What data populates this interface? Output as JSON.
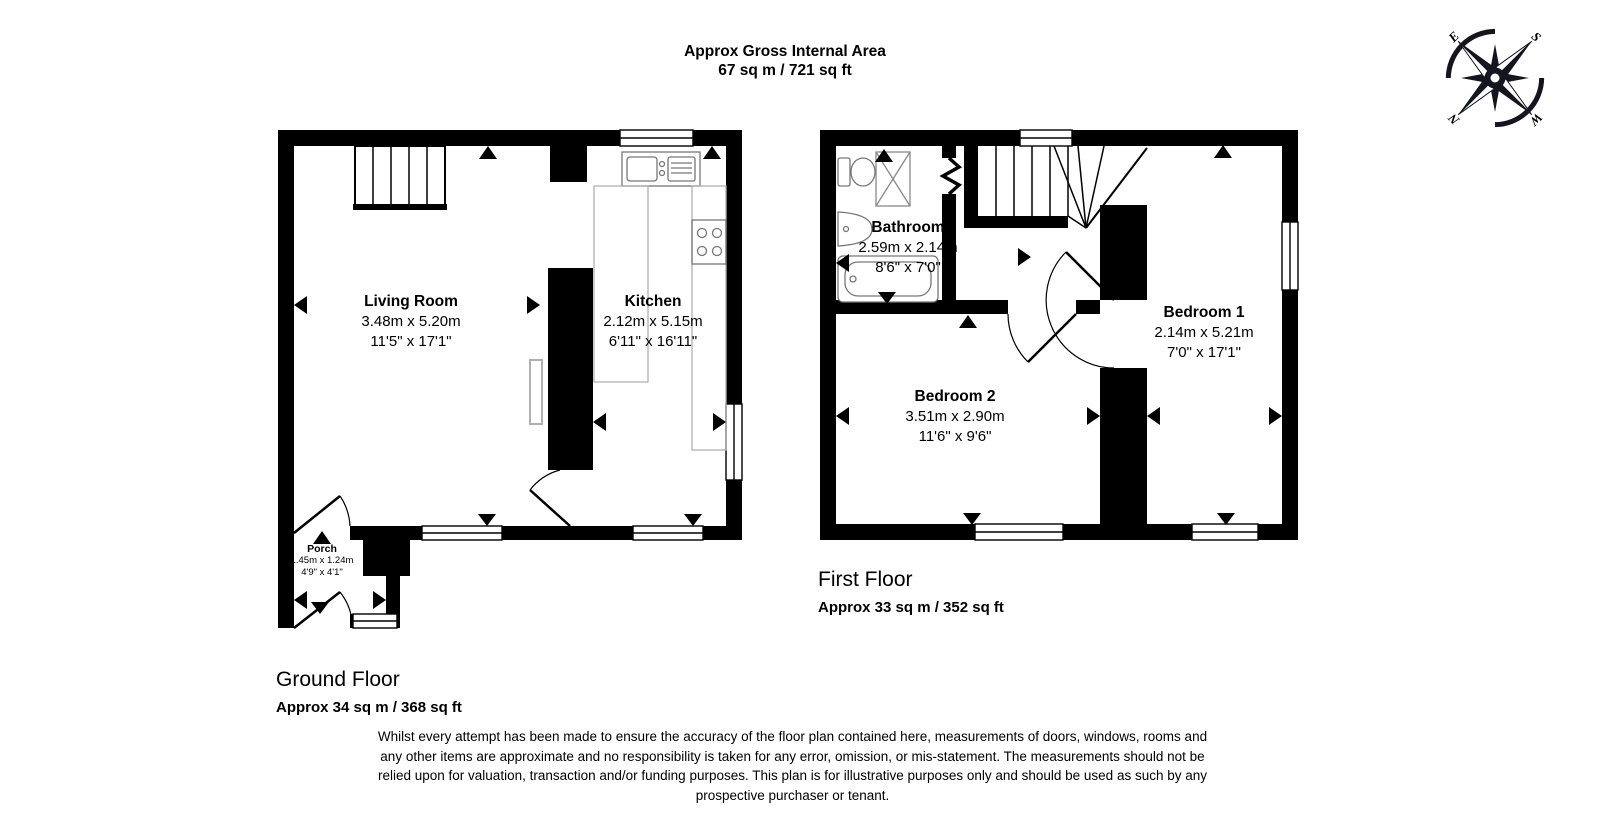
{
  "header": {
    "title_line1": "Approx Gross Internal Area",
    "title_line2": "67 sq m / 721 sq ft"
  },
  "compass": {
    "n": "N",
    "e": "E",
    "s": "S",
    "w": "W"
  },
  "ground_floor": {
    "caption": "Ground Floor",
    "area": "Approx 34 sq m / 368 sq ft",
    "rooms": {
      "living_room": {
        "name": "Living Room",
        "metric": "3.48m x 5.20m",
        "imperial": "11'5\" x 17'1\""
      },
      "kitchen": {
        "name": "Kitchen",
        "metric": "2.12m x 5.15m",
        "imperial": "6'11\" x 16'11\""
      },
      "porch": {
        "name": "Porch",
        "metric": "1.45m x 1.24m",
        "imperial": "4'9\" x 4'1\""
      }
    }
  },
  "first_floor": {
    "caption": "First Floor",
    "area": "Approx 33 sq m / 352 sq ft",
    "rooms": {
      "bathroom": {
        "name": "Bathroom",
        "metric": "2.59m x 2.14m",
        "imperial": "8'6\" x 7'0\""
      },
      "bedroom1": {
        "name": "Bedroom 1",
        "metric": "2.14m x 5.21m",
        "imperial": "7'0\" x 17'1\""
      },
      "bedroom2": {
        "name": "Bedroom 2",
        "metric": "3.51m x 2.90m",
        "imperial": "11'6\" x 9'6\""
      }
    }
  },
  "disclaimer": "Whilst every attempt has been made to ensure the accuracy of the floor plan contained here, measurements of doors, windows, rooms and any other items are approximate and no responsibility is taken for any error, omission, or mis-statement. The measurements should not be relied upon for valuation, transaction and/or funding purposes. This plan is for illustrative purposes only and should be used as such by any prospective purchaser or tenant.",
  "colors": {
    "wall": "#000000",
    "fixture": "#777777",
    "counter": "#b0b0b0",
    "background": "#ffffff"
  }
}
